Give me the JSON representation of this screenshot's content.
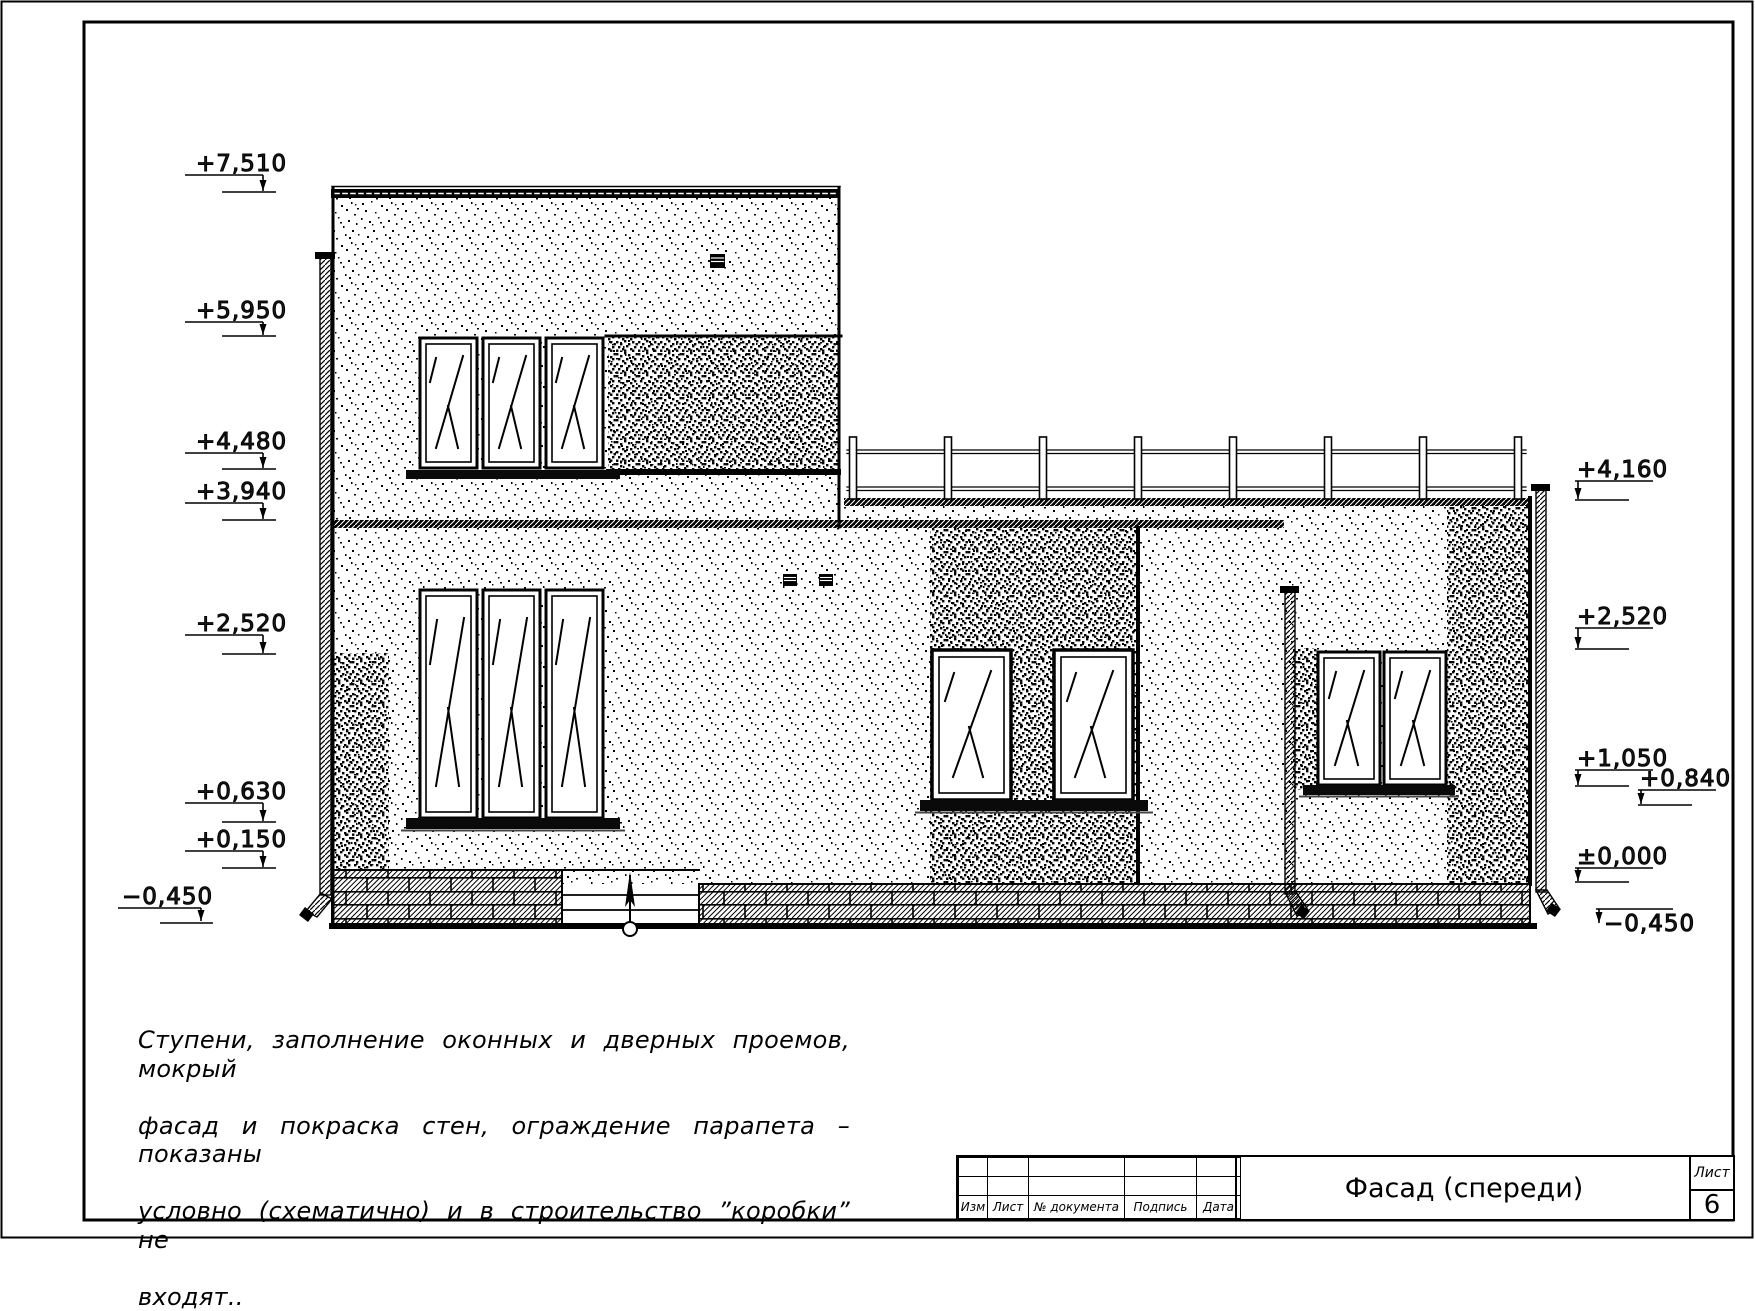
{
  "sheet": {
    "title": "Фасад (спереди)",
    "sheet_label": "Лист",
    "sheet_number": "6",
    "ink_color": "#000000",
    "paper_color": "#ffffff"
  },
  "title_block": {
    "columns": [
      "Изм",
      "Лист",
      "№ документа",
      "Подпись",
      "Дата"
    ]
  },
  "note": {
    "lines": [
      "Ступени, заполнение оконных и дверных проемов, мокрый",
      "фасад и покраска стен, ограждение парапета – показаны",
      "условно (схематично) и в строительство ”коробки” не",
      "входят.."
    ]
  },
  "elevation_marks": {
    "left": [
      "+7,510",
      "+5,950",
      "+4,480",
      "+3,940",
      "+2,520",
      "+0,630",
      "+0,150",
      "−0,450"
    ],
    "right": [
      "+4,160",
      "+2,520",
      "+1,050",
      "+0,840",
      "±0,000",
      "−0,450"
    ]
  }
}
